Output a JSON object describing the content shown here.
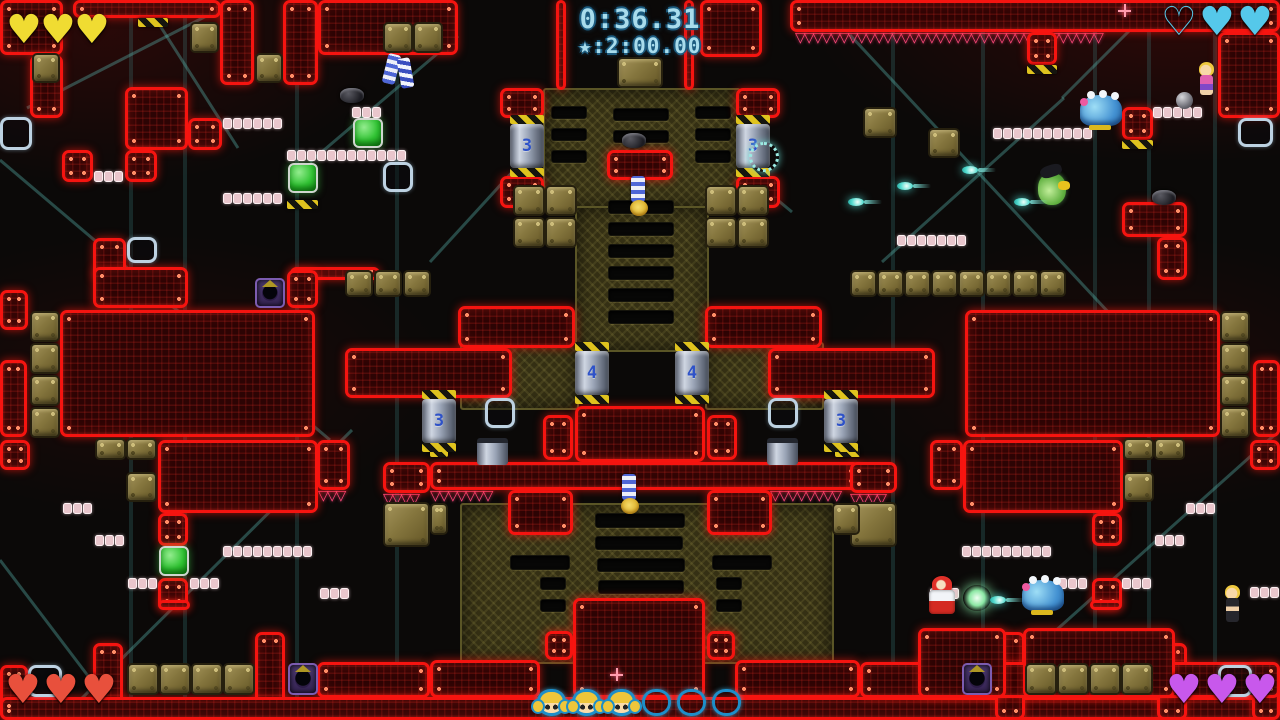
{
  "hud": {
    "timer": {
      "current": "0:36.31",
      "target": "★:2:00.00"
    },
    "hearts": {
      "top_left": {
        "x": 6,
        "y": 10,
        "dx": 34,
        "color": "#f0dc32",
        "slots": [
          "full",
          "full",
          "full"
        ]
      },
      "top_right": {
        "x": 1161,
        "y": 2,
        "dx": 38,
        "color": "#55c8ea",
        "slots": [
          "empty",
          "full",
          "full"
        ]
      },
      "bottom_left": {
        "x": 5,
        "y": 670,
        "dx": 38,
        "color": "#e8503c",
        "slots": [
          "full",
          "full",
          "full"
        ]
      },
      "bottom_right": {
        "x": 1166,
        "y": 670,
        "dx": 38,
        "color": "#c858ec",
        "slots": [
          "full",
          "full",
          "full"
        ]
      }
    },
    "rescues": {
      "x": 537,
      "y": 689,
      "dx": 35,
      "icons": [
        "full",
        "full",
        "full",
        "empty",
        "empty",
        "empty"
      ]
    },
    "glyph_full": "♥",
    "glyph_empty": "♡",
    "spike_glyph": "▽"
  },
  "level": {
    "red_blocks": [
      [
        0,
        0,
        63,
        55
      ],
      [
        30,
        55,
        33,
        63
      ],
      [
        73,
        0,
        148,
        18
      ],
      [
        220,
        0,
        34,
        85
      ],
      [
        283,
        0,
        35,
        85
      ],
      [
        318,
        0,
        140,
        55
      ],
      [
        700,
        0,
        62,
        57
      ],
      [
        125,
        87,
        63,
        63
      ],
      [
        188,
        118,
        34,
        32
      ],
      [
        62,
        150,
        31,
        32
      ],
      [
        125,
        150,
        32,
        32
      ],
      [
        93,
        238,
        33,
        42
      ],
      [
        93,
        267,
        95,
        41
      ],
      [
        290,
        267,
        90,
        13
      ],
      [
        287,
        270,
        31,
        38
      ],
      [
        0,
        290,
        28,
        40
      ],
      [
        60,
        310,
        255,
        127
      ],
      [
        0,
        360,
        27,
        77
      ],
      [
        158,
        440,
        160,
        73
      ],
      [
        317,
        440,
        33,
        50
      ],
      [
        0,
        440,
        30,
        30
      ],
      [
        383,
        462,
        47,
        31
      ],
      [
        158,
        513,
        30,
        33
      ],
      [
        158,
        578,
        30,
        32
      ],
      [
        158,
        600,
        32,
        10
      ],
      [
        93,
        643,
        30,
        77
      ],
      [
        255,
        632,
        30,
        88
      ],
      [
        0,
        665,
        28,
        55
      ],
      [
        317,
        662,
        113,
        36
      ],
      [
        556,
        0,
        10,
        90
      ],
      [
        684,
        0,
        10,
        90
      ],
      [
        500,
        88,
        44,
        30
      ],
      [
        736,
        88,
        44,
        30
      ],
      [
        607,
        150,
        66,
        30
      ],
      [
        500,
        176,
        44,
        32
      ],
      [
        736,
        176,
        44,
        32
      ],
      [
        458,
        306,
        117,
        42
      ],
      [
        705,
        306,
        117,
        42
      ],
      [
        345,
        348,
        167,
        50
      ],
      [
        768,
        348,
        167,
        50
      ],
      [
        543,
        415,
        30,
        45
      ],
      [
        575,
        406,
        130,
        56
      ],
      [
        707,
        415,
        30,
        45
      ],
      [
        430,
        462,
        430,
        28
      ],
      [
        508,
        490,
        65,
        45
      ],
      [
        707,
        490,
        65,
        45
      ],
      [
        573,
        598,
        132,
        100
      ],
      [
        545,
        631,
        28,
        29
      ],
      [
        707,
        631,
        28,
        29
      ],
      [
        430,
        660,
        110,
        38
      ],
      [
        735,
        660,
        125,
        38
      ],
      [
        0,
        697,
        1280,
        23
      ],
      [
        790,
        0,
        490,
        32
      ],
      [
        1027,
        32,
        30,
        33
      ],
      [
        1218,
        32,
        62,
        86
      ],
      [
        1122,
        107,
        31,
        33
      ],
      [
        1122,
        202,
        65,
        35
      ],
      [
        1157,
        237,
        30,
        43
      ],
      [
        965,
        310,
        255,
        127
      ],
      [
        1253,
        360,
        27,
        77
      ],
      [
        963,
        440,
        160,
        73
      ],
      [
        930,
        440,
        33,
        50
      ],
      [
        1250,
        440,
        30,
        30
      ],
      [
        850,
        462,
        47,
        31
      ],
      [
        1092,
        513,
        30,
        33
      ],
      [
        1092,
        578,
        30,
        32
      ],
      [
        1090,
        600,
        32,
        10
      ],
      [
        1157,
        643,
        30,
        77
      ],
      [
        995,
        632,
        30,
        88
      ],
      [
        1252,
        665,
        28,
        55
      ],
      [
        860,
        662,
        420,
        36
      ],
      [
        918,
        628,
        88,
        70
      ],
      [
        1023,
        628,
        152,
        70
      ]
    ],
    "tan_blocks": [
      [
        32,
        53,
        28,
        30
      ],
      [
        190,
        22,
        29,
        31
      ],
      [
        255,
        53,
        28,
        30
      ],
      [
        383,
        22,
        30,
        31
      ],
      [
        413,
        22,
        30,
        31
      ],
      [
        345,
        270,
        28,
        27
      ],
      [
        374,
        270,
        28,
        27
      ],
      [
        403,
        270,
        28,
        27
      ],
      [
        30,
        311,
        30,
        31
      ],
      [
        30,
        343,
        30,
        31
      ],
      [
        30,
        375,
        30,
        31
      ],
      [
        30,
        407,
        30,
        31
      ],
      [
        95,
        438,
        31,
        22
      ],
      [
        126,
        438,
        31,
        22
      ],
      [
        126,
        472,
        31,
        30
      ],
      [
        863,
        107,
        34,
        31
      ],
      [
        928,
        128,
        32,
        30
      ],
      [
        850,
        270,
        27,
        27
      ],
      [
        877,
        270,
        27,
        27
      ],
      [
        904,
        270,
        27,
        27
      ],
      [
        931,
        270,
        27,
        27
      ],
      [
        958,
        270,
        27,
        27
      ],
      [
        985,
        270,
        27,
        27
      ],
      [
        1012,
        270,
        27,
        27
      ],
      [
        1039,
        270,
        27,
        27
      ],
      [
        1220,
        311,
        30,
        31
      ],
      [
        1220,
        343,
        30,
        31
      ],
      [
        1220,
        375,
        30,
        31
      ],
      [
        1220,
        407,
        30,
        31
      ],
      [
        1123,
        438,
        31,
        22
      ],
      [
        1154,
        438,
        31,
        22
      ],
      [
        1123,
        472,
        31,
        30
      ],
      [
        127,
        663,
        32,
        32
      ],
      [
        159,
        663,
        32,
        32
      ],
      [
        191,
        663,
        32,
        32
      ],
      [
        223,
        663,
        32,
        32
      ],
      [
        1025,
        663,
        32,
        32
      ],
      [
        1057,
        663,
        32,
        32
      ],
      [
        1089,
        663,
        32,
        32
      ],
      [
        1121,
        663,
        32,
        32
      ],
      [
        513,
        185,
        32,
        31
      ],
      [
        545,
        185,
        32,
        31
      ],
      [
        705,
        185,
        32,
        31
      ],
      [
        737,
        185,
        32,
        31
      ],
      [
        513,
        217,
        32,
        31
      ],
      [
        545,
        217,
        32,
        31
      ],
      [
        705,
        217,
        32,
        31
      ],
      [
        737,
        217,
        32,
        31
      ],
      [
        617,
        57,
        46,
        31
      ],
      [
        383,
        502,
        47,
        45
      ],
      [
        850,
        502,
        47,
        45
      ],
      [
        430,
        503,
        18,
        32
      ],
      [
        832,
        503,
        28,
        32
      ]
    ],
    "green_blocks": [
      [
        353,
        118,
        30,
        30
      ],
      [
        288,
        163,
        30,
        30
      ],
      [
        159,
        546,
        30,
        30
      ]
    ],
    "purple_blocks": [
      [
        255,
        278,
        30,
        30
      ],
      [
        288,
        663,
        30,
        32
      ],
      [
        962,
        663,
        30,
        32
      ]
    ],
    "pink_rows": [
      [
        94,
        171,
        3
      ],
      [
        352,
        107,
        3
      ],
      [
        223,
        118,
        6
      ],
      [
        287,
        150,
        12
      ],
      [
        223,
        193,
        6
      ],
      [
        63,
        503,
        3
      ],
      [
        95,
        535,
        3
      ],
      [
        128,
        578,
        3
      ],
      [
        190,
        578,
        3
      ],
      [
        223,
        546,
        9
      ],
      [
        320,
        588,
        3
      ],
      [
        993,
        128,
        10
      ],
      [
        1153,
        107,
        5
      ],
      [
        897,
        235,
        7
      ],
      [
        1186,
        503,
        3
      ],
      [
        1155,
        535,
        3
      ],
      [
        1122,
        578,
        3
      ],
      [
        1058,
        578,
        3
      ],
      [
        962,
        546,
        9
      ],
      [
        930,
        588,
        3
      ],
      [
        1250,
        587,
        3
      ]
    ],
    "olive_panels": [
      [
        543,
        88,
        194,
        118
      ],
      [
        575,
        206,
        130,
        142
      ],
      [
        460,
        342,
        115,
        64
      ],
      [
        705,
        342,
        115,
        64
      ],
      [
        460,
        503,
        370,
        157
      ]
    ],
    "slots": [
      [
        551,
        106,
        34,
        11
      ],
      [
        551,
        128,
        34,
        11
      ],
      [
        551,
        150,
        34,
        11
      ],
      [
        695,
        106,
        34,
        11
      ],
      [
        695,
        128,
        34,
        11
      ],
      [
        695,
        150,
        34,
        11
      ],
      [
        613,
        108,
        54,
        11
      ],
      [
        613,
        130,
        54,
        11
      ],
      [
        608,
        200,
        64,
        12
      ],
      [
        608,
        222,
        64,
        12
      ],
      [
        608,
        244,
        64,
        12
      ],
      [
        608,
        266,
        64,
        12
      ],
      [
        608,
        288,
        64,
        12
      ],
      [
        608,
        310,
        64,
        12
      ],
      [
        595,
        513,
        88,
        13
      ],
      [
        595,
        536,
        86,
        12
      ],
      [
        597,
        558,
        86,
        12
      ],
      [
        598,
        580,
        84,
        12
      ],
      [
        510,
        555,
        58,
        13
      ],
      [
        712,
        555,
        58,
        13
      ],
      [
        540,
        577,
        24,
        11
      ],
      [
        716,
        577,
        24,
        11
      ],
      [
        540,
        599,
        24,
        11
      ],
      [
        716,
        599,
        24,
        11
      ]
    ],
    "hazards": [
      [
        138,
        18,
        30
      ],
      [
        1027,
        65,
        30
      ],
      [
        287,
        200,
        31
      ],
      [
        1122,
        140,
        31
      ],
      [
        430,
        448,
        18
      ],
      [
        835,
        448,
        25
      ]
    ],
    "spikes": [
      [
        795,
        32,
        385
      ],
      [
        318,
        490,
        32
      ],
      [
        430,
        490,
        78
      ],
      [
        770,
        490,
        90
      ],
      [
        383,
        493,
        47
      ],
      [
        850,
        493,
        45
      ]
    ],
    "brackets": [
      [
        0,
        117,
        32,
        33
      ],
      [
        383,
        162,
        30,
        30
      ],
      [
        127,
        237,
        30,
        26
      ],
      [
        28,
        665,
        34,
        32
      ],
      [
        485,
        398,
        30,
        30
      ],
      [
        768,
        398,
        30,
        30
      ],
      [
        1238,
        118,
        35,
        29
      ],
      [
        1218,
        665,
        34,
        32
      ]
    ],
    "pistons": [
      [
        510,
        115,
        "3"
      ],
      [
        736,
        115,
        "3"
      ],
      [
        575,
        342,
        "4"
      ],
      [
        675,
        342,
        "4"
      ],
      [
        422,
        390,
        "3"
      ],
      [
        824,
        390,
        "3"
      ]
    ],
    "piston_stubs": [
      [
        477,
        438,
        31,
        22
      ],
      [
        767,
        438,
        31,
        22
      ]
    ],
    "sprites": [
      [
        "player-upside-down",
        "p-upd",
        627,
        176
      ],
      [
        "player-upside-down",
        "p-upd",
        618,
        474
      ],
      [
        "hooligan-pair",
        "p-pair",
        383,
        52
      ],
      [
        "small-dark-enemy",
        "enemy-dark",
        340,
        88
      ],
      [
        "small-dark-enemy",
        "enemy-dark",
        622,
        133
      ],
      [
        "small-dark-enemy",
        "enemy-dark",
        1152,
        190
      ],
      [
        "blob-enemy",
        "blob",
        1080,
        95
      ],
      [
        "blob-enemy",
        "blob",
        1022,
        580
      ],
      [
        "green-enemy",
        "enemy-green",
        1038,
        173
      ],
      [
        "hooligan-sister-pink",
        "sister-pink",
        1196,
        62
      ],
      [
        "gray-ball",
        "gray-ball",
        1176,
        92
      ],
      [
        "player-red-armor",
        "p-red",
        925,
        576
      ],
      [
        "muzzle-flash",
        "flash",
        963,
        585
      ],
      [
        "hooligan-sister-dark",
        "sister-dark",
        1222,
        585
      ],
      [
        "target-reticle",
        "reticle",
        749,
        142
      ],
      [
        "sparkle",
        "sparkle",
        610,
        668
      ],
      [
        "sparkle",
        "sparkle",
        1118,
        4
      ]
    ],
    "projectiles": [
      [
        962,
        166
      ],
      [
        897,
        182
      ],
      [
        848,
        198
      ],
      [
        1014,
        198
      ],
      [
        990,
        596
      ]
    ],
    "beams": [
      [
        27,
        108,
        222,
        8
      ],
      [
        0,
        160,
        330,
        440
      ],
      [
        62,
        718,
        352,
        430
      ],
      [
        310,
        162,
        458,
        36
      ],
      [
        430,
        262,
        558,
        122
      ],
      [
        850,
        35,
        1192,
        402
      ],
      [
        882,
        262,
        1064,
        98
      ],
      [
        958,
        718,
        1280,
        430
      ],
      [
        684,
        122,
        792,
        212
      ],
      [
        150,
        10,
        238,
        148
      ],
      [
        1062,
        98,
        1150,
        10
      ],
      [
        0,
        560,
        120,
        718
      ]
    ],
    "struts": [
      131,
      185,
      297,
      397,
      893,
      983,
      1095,
      1149,
      1215
    ]
  }
}
